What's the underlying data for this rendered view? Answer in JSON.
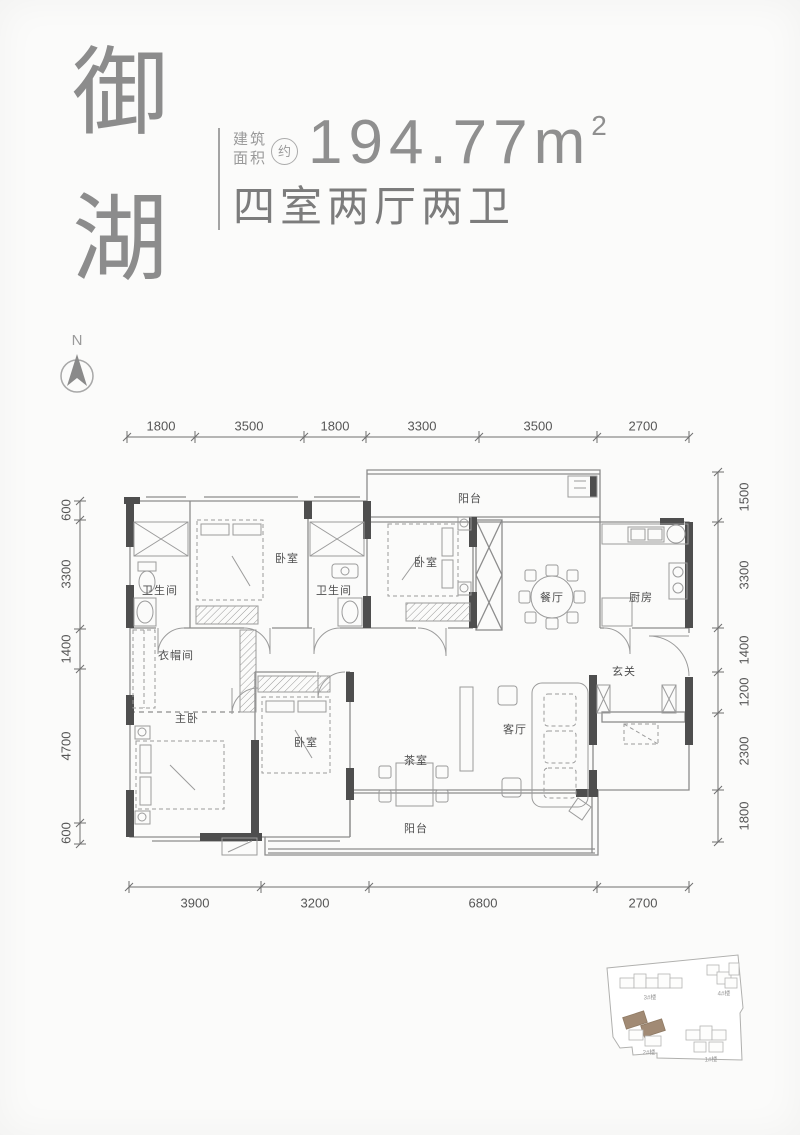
{
  "header": {
    "brand_char_1": "御",
    "brand_char_2": "湖",
    "area_label_line1": "建筑",
    "area_label_line2": "面积",
    "approx": "约",
    "area_value": "194.77m",
    "area_exponent": "2",
    "layout_summary": "四室两厅两卫"
  },
  "compass": {
    "north_label": "N"
  },
  "plan": {
    "rooms": {
      "balcony_top": "阳台",
      "bathroom_1": "卫生间",
      "bedroom_1": "卧室",
      "bathroom_2": "卫生间",
      "bedroom_2": "卧室",
      "dining": "餐厅",
      "kitchen": "厨房",
      "cloakroom": "衣帽间",
      "foyer": "玄关",
      "master_bedroom": "主卧",
      "bedroom_3": "卧室",
      "tea_room": "茶室",
      "living": "客厅",
      "balcony_bottom": "阳台"
    },
    "dimensions": {
      "top": [
        "1800",
        "3500",
        "1800",
        "3300",
        "3500",
        "2700"
      ],
      "bottom": [
        "3900",
        "3200",
        "6800",
        "2700"
      ],
      "left": [
        "600",
        "3300",
        "1400",
        "4700",
        "600"
      ],
      "right": [
        "1500",
        "3300",
        "1400",
        "1200",
        "2300",
        "1800"
      ]
    }
  },
  "site_map": {
    "buildings": [
      "3#楼",
      "4#楼",
      "2#楼",
      "1#楼"
    ]
  },
  "colors": {
    "wall": "#4e4e4e",
    "line": "#8c8c8c",
    "highlight": "#a18a74"
  }
}
